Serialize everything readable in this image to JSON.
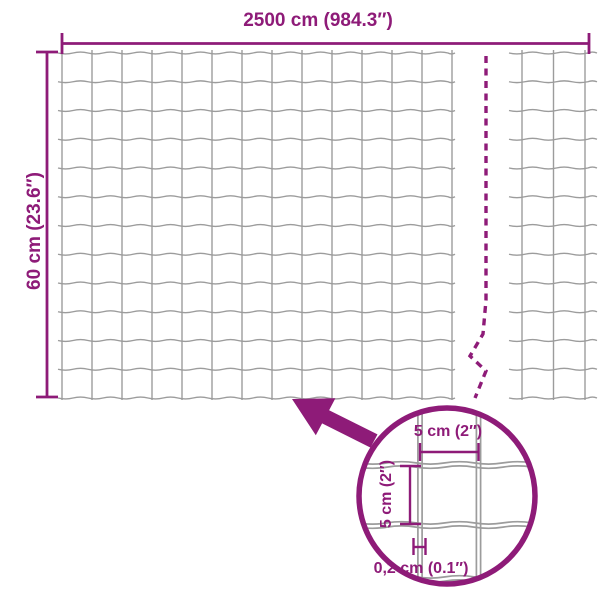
{
  "diagram": {
    "colors": {
      "accent": "#8e1b78",
      "wire": "#9c9c9c"
    },
    "dimensions": {
      "width_label": "2500 cm (984.3″)",
      "height_label": "60 cm (23.6″)"
    },
    "detail": {
      "cell_width_label": "5 cm (2″)",
      "cell_height_label": "5 cm (2″)",
      "thickness_label": "0,2 cm (0.1″)"
    },
    "mesh": {
      "main": {
        "left": 62,
        "top": 53,
        "cols": 13,
        "rows": 12,
        "col_spacing": 30,
        "row_spacing": 28.75,
        "h_span": [
          58,
          455
        ],
        "v_span": [
          50,
          400
        ],
        "wave_period": 30,
        "wave_amp": 1.8
      },
      "continuation": {
        "left": 522,
        "top": 53,
        "cols": 2,
        "rows": 12,
        "col_spacing": 31.5,
        "row_spacing": 28.75,
        "h_span": [
          509,
          597
        ],
        "v_span": [
          50,
          400
        ],
        "wave_period": 31.5,
        "wave_amp": 1.8
      },
      "detail_mesh": {
        "verticals": [
          420,
          478.5
        ],
        "horizontals": [
          465,
          525,
          579
        ],
        "pair_gap": 2.1,
        "h_span": [
          358,
          540
        ],
        "v_span": [
          404,
          588
        ],
        "wave_period": 58,
        "wave_amp": 2.4
      }
    }
  }
}
